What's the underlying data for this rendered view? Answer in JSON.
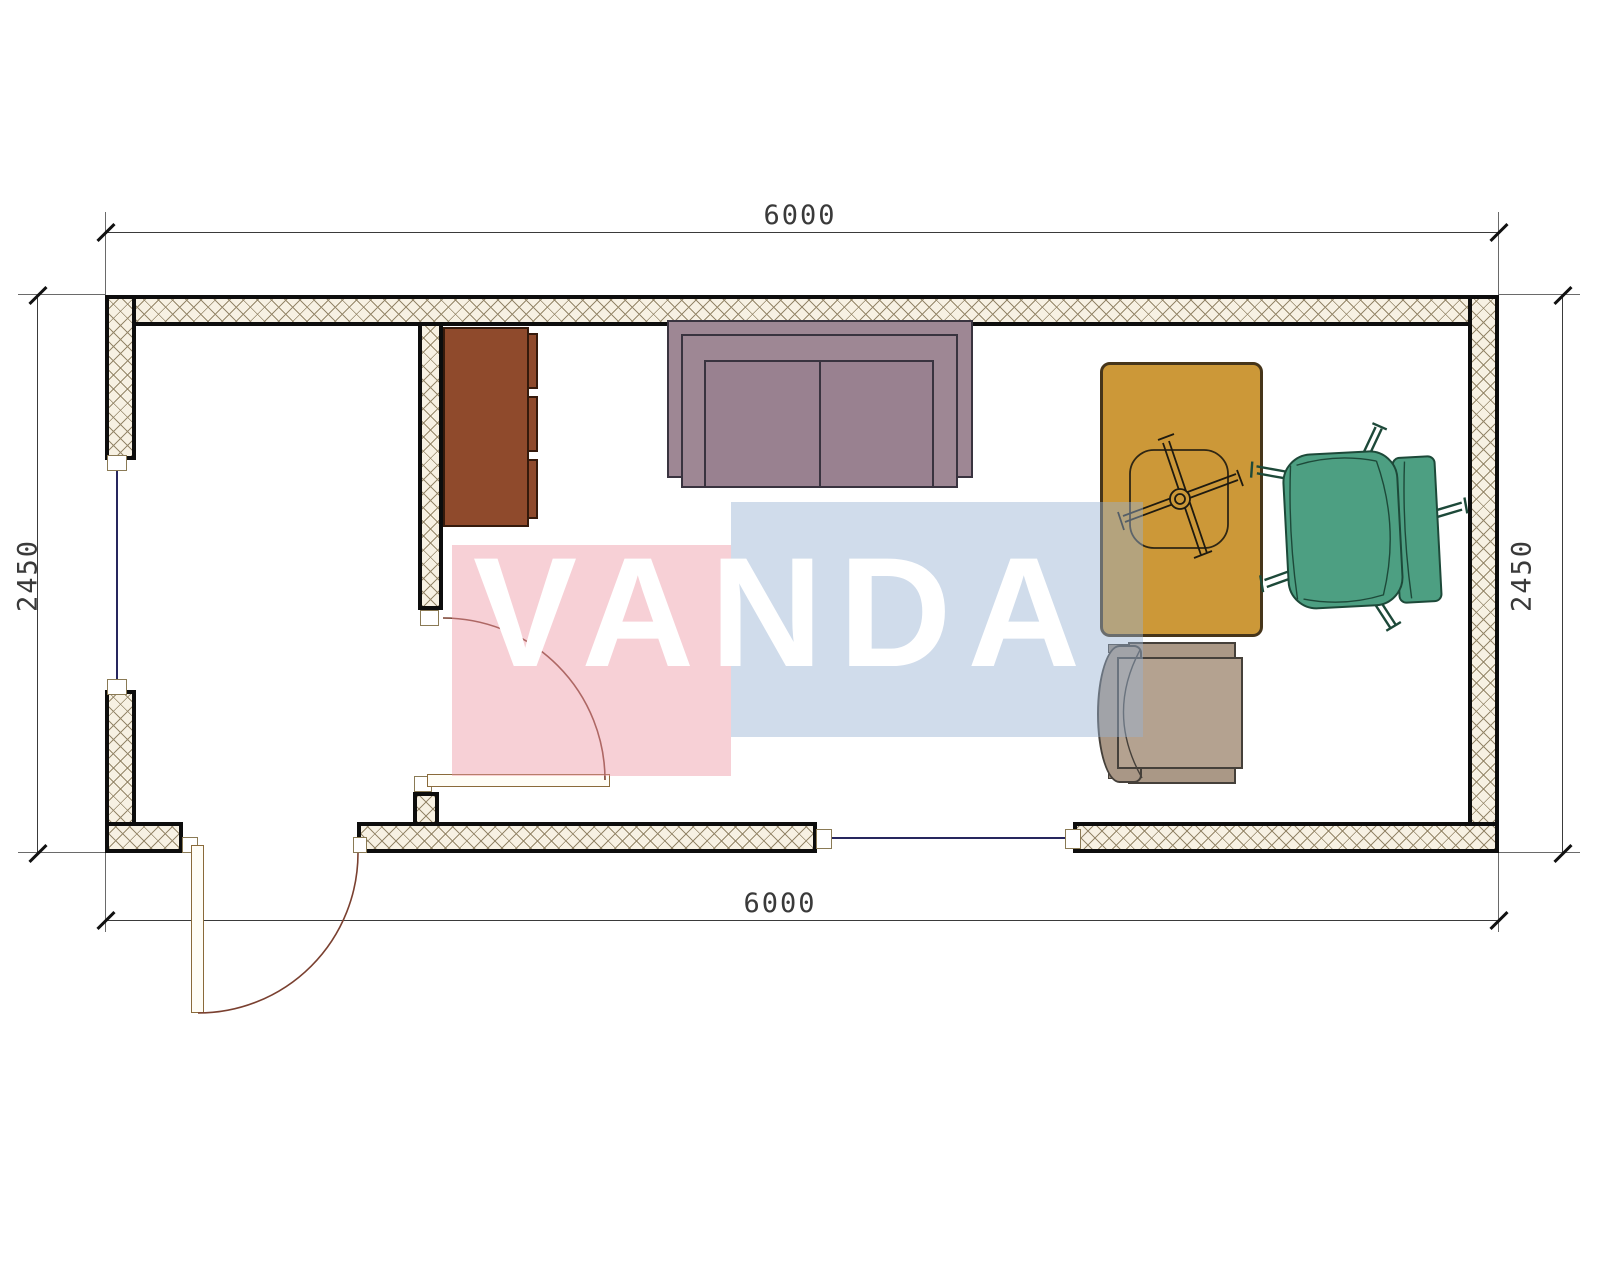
{
  "drawing": {
    "type": "floor-plan",
    "room_width_mm": "6000",
    "room_depth_mm": "2450"
  },
  "dimensions": {
    "top": "6000",
    "bottom": "6000",
    "left": "2450",
    "right": "2450"
  },
  "watermark": {
    "text": "VANDA",
    "pink_block_color": "#f6cad2",
    "blue_block_color": "#cdd9e8"
  },
  "colors": {
    "wall_hatch_bg": "#f7f1e3",
    "wall_hatch_line": "#95876a",
    "wall_border": "#0d0d0d",
    "window_glass": "#26265e",
    "door_swing": "#7a4030",
    "cabinet": "#8f4a2c",
    "sofa": "#9e8794",
    "desk": "#cc9838",
    "office_chair": "#4d9f82",
    "armchair": "#b4a290"
  },
  "furniture": {
    "cabinet": "cabinet",
    "sofa": "two-seat sofa",
    "desk": "desk with swivel-chair base",
    "office_chair": "office chair",
    "armchair": "armchair"
  }
}
